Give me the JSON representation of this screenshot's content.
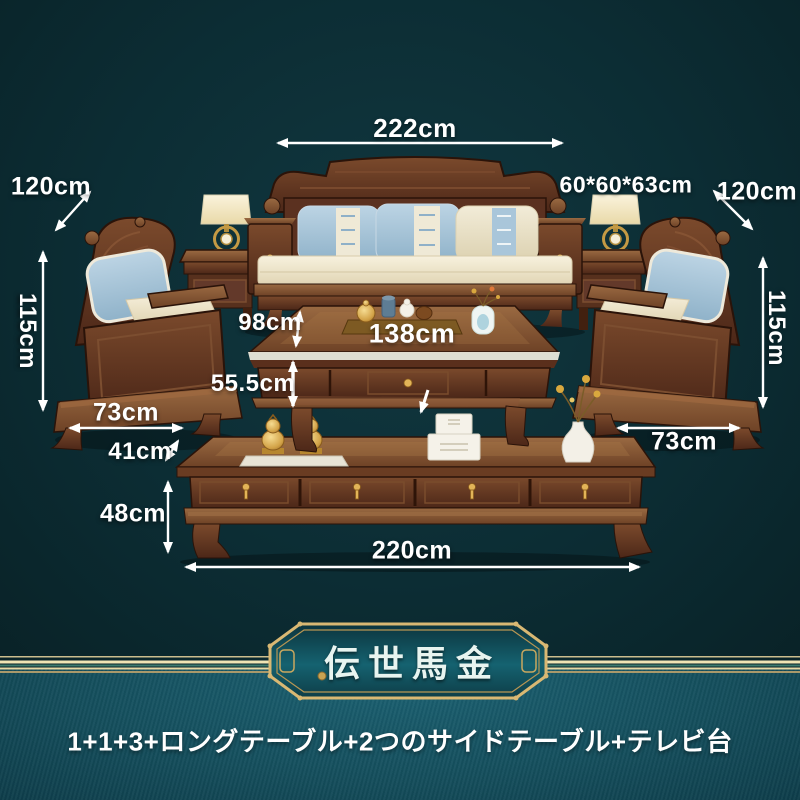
{
  "theme": {
    "background_top": "#0c2c33",
    "background_bottom": "#175867",
    "gold_accent": "#dfc48a",
    "label_color": "#ffffff",
    "wood_brown": "#6b4026",
    "pillow_blue": "#a9c6da",
    "cushion_cream": "#f1ebd8"
  },
  "annotations": {
    "sofa_width": "222cm",
    "left_chair_depth": "120cm",
    "right_chair_depth": "120cm",
    "side_table_size": "60*60*63cm",
    "left_chair_height": "115cm",
    "right_chair_height": "115cm",
    "coffee_table_front_height": "98cm",
    "coffee_table_length": "138cm",
    "coffee_table_height": "55.5cm",
    "left_chair_width": "73cm",
    "right_chair_width": "73cm",
    "tv_stand_top_depth": "41cm",
    "tv_stand_height": "48cm",
    "tv_stand_length": "220cm"
  },
  "banner": {
    "title": "伝世馬金"
  },
  "footer": {
    "set_description": "1+1+3+ロングテーブル+2つのサイドテーブル+テレビ台"
  }
}
